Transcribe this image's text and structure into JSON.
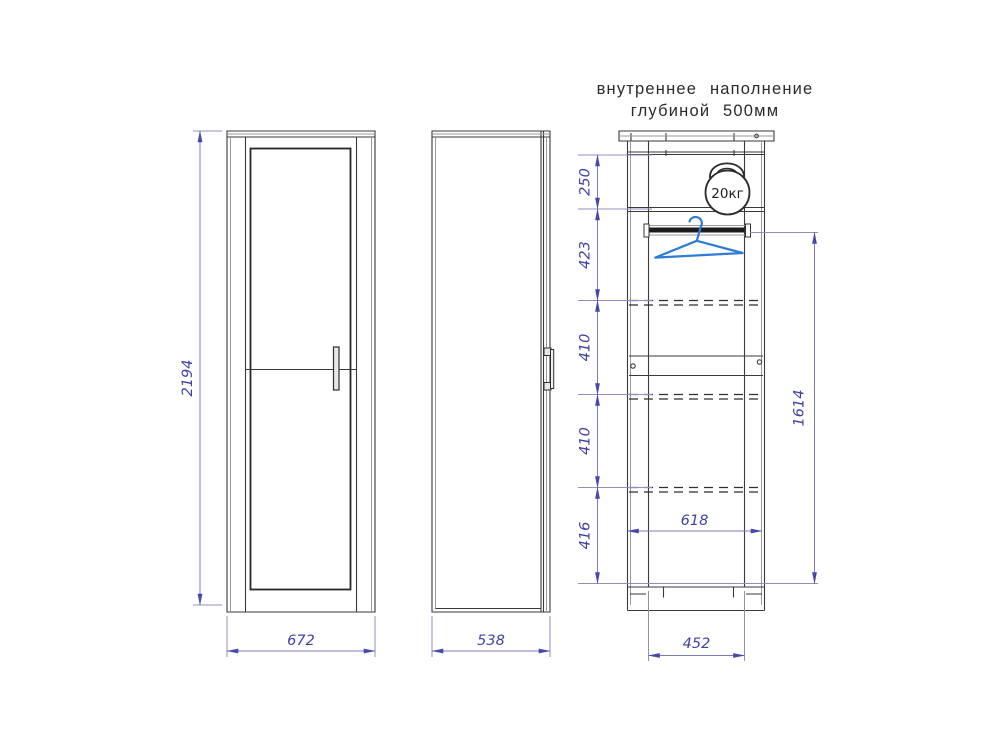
{
  "title": {
    "line1": "внутреннее наполнение",
    "line2": "глубиной 500мм"
  },
  "front_view": {
    "height": "2194",
    "width": "672"
  },
  "side_view": {
    "width": "538"
  },
  "internal_view": {
    "weight": "20кг",
    "segments": [
      "250",
      "423",
      "410",
      "410",
      "416"
    ],
    "inner_width": "618",
    "hanging_height": "1614",
    "base_width": "452"
  },
  "colors": {
    "dimension_text": "#3f3fa8",
    "dimension_line": "#7b7bba",
    "drawing_line": "#3a3a3a",
    "hanger_blue": "#2e7cd6"
  }
}
